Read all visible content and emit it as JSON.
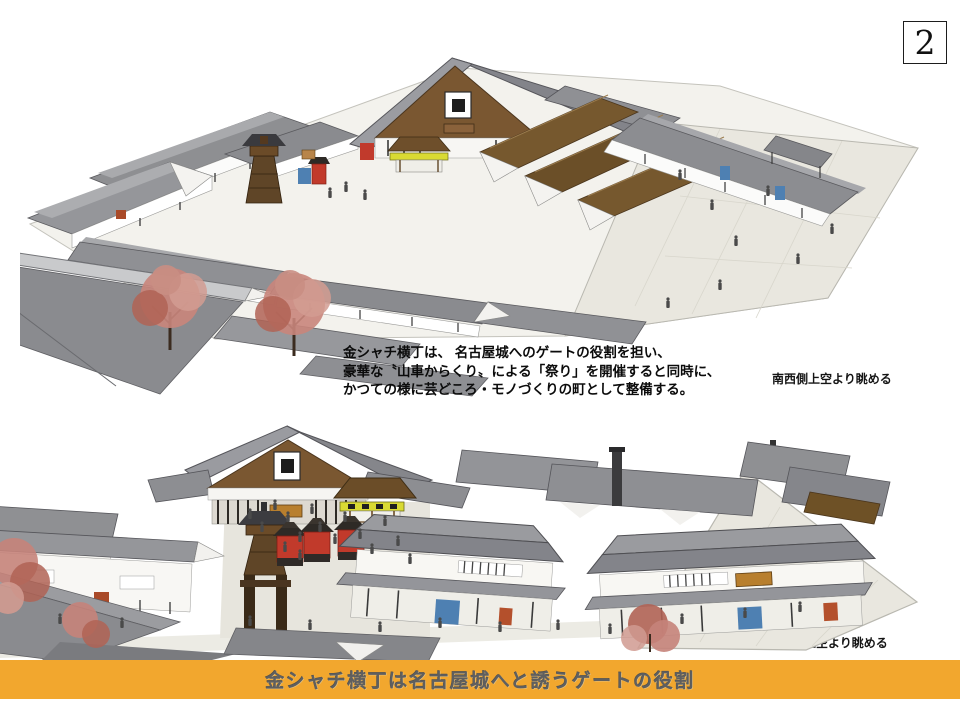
{
  "page": {
    "number": "2"
  },
  "description": {
    "lines": [
      "金シャチ横丁は、 名古屋城へのゲートの役割を担い、",
      "豪華な〝山車からくり〟による「祭り」を開催すると同時に、",
      "かつての様に芸どころ・モノづくりの町として整備する。"
    ]
  },
  "top_view": {
    "caption": "南西側上空より眺める"
  },
  "bottom_view": {
    "caption": "西側上空より眺める"
  },
  "banner": {
    "title": "金シャチ横丁は名古屋城へと誘うゲートの役割",
    "background": "#F2A72E",
    "text_color": "#5F5F5F"
  },
  "palette": {
    "roof_gray": "#8A8B8F",
    "roof_gray_light": "#A8A9AC",
    "roof_brown": "#76582E",
    "wall_white": "#F8F7F3",
    "wood_dark": "#5F4527",
    "plaza": "#E9E7DF",
    "accent_red": "#C13A2B",
    "accent_blue": "#4E80B2",
    "accent_yellow": "#D9DA33",
    "sign_orange": "#B87F2E",
    "door_red": "#A94A28",
    "tree_pink": "#C5837A"
  }
}
